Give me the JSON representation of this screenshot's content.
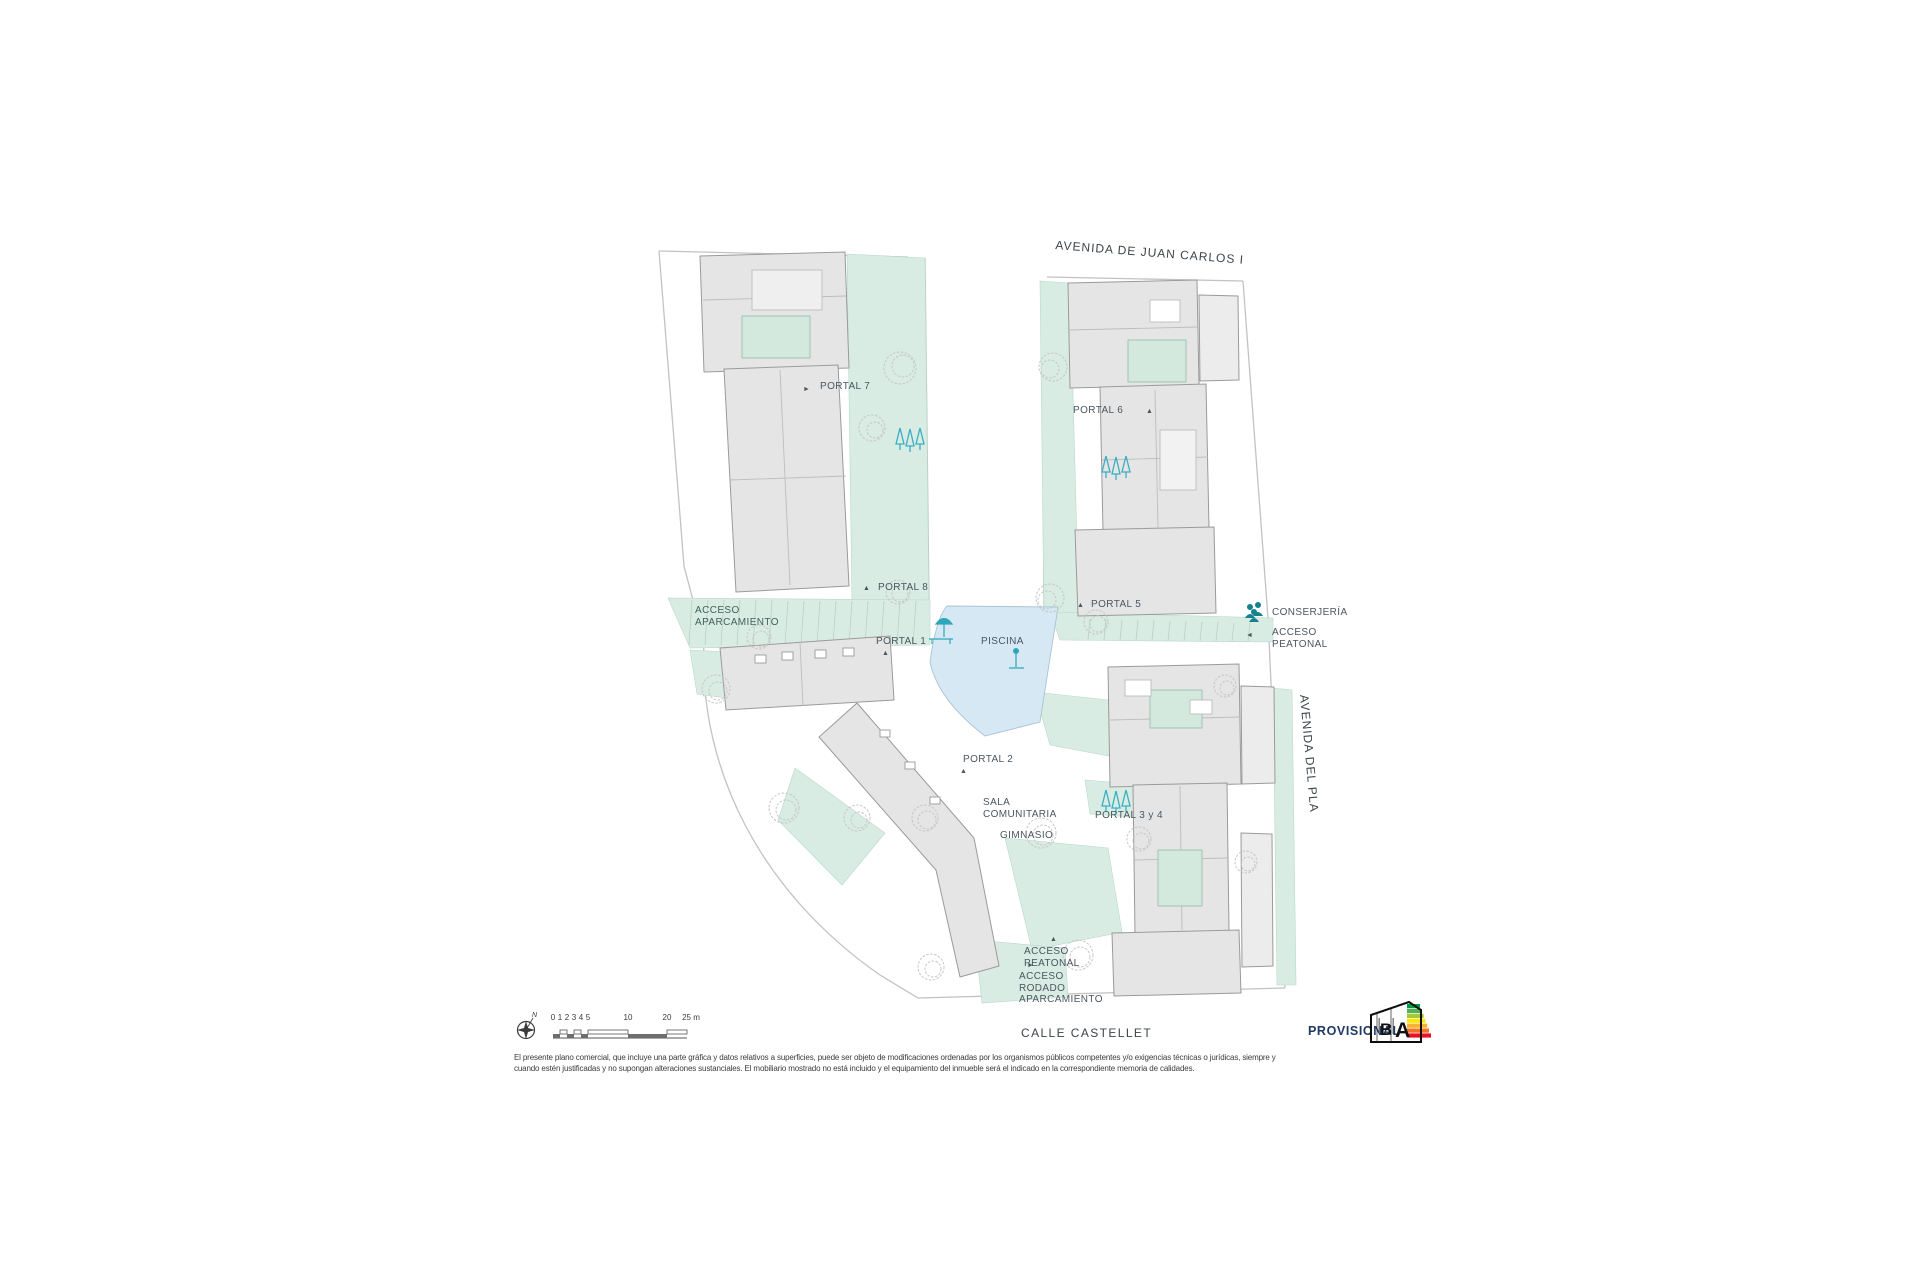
{
  "streets": {
    "top": "AVENIDA DE JUAN CARLOS I",
    "right": "AVENIDA DEL PLA",
    "bottom": "CALLE CASTELLET"
  },
  "labels": {
    "portal7": "PORTAL 7",
    "portal6": "PORTAL 6",
    "portal8": "PORTAL 8",
    "portal5": "PORTAL 5",
    "portal1": "PORTAL 1",
    "portal2": "PORTAL 2",
    "portal34": "PORTAL 3 y 4",
    "piscina": "PISCINA",
    "conserjeria": "CONSERJERÍA",
    "acceso_peatonal": "ACCESO\nPEATONAL",
    "acceso_aparcamiento": "ACCESO\nAPARCAMIENTO",
    "sala_comunitaria": "SALA\nCOMUNITARIA",
    "gimnasio": "GIMNASIO",
    "acceso_peatonal_sur": "ACCESO\nPEATONAL",
    "acceso_rodado": "ACCESO\nRODADO\nAPARCAMIENTO"
  },
  "icons": {
    "triangle_up": "▲",
    "triangle_right": "►",
    "triangle_left": "◄",
    "north": "N"
  },
  "scalebar": {
    "ticks": [
      "0",
      "1",
      "2",
      "3",
      "4",
      "5",
      "10",
      "20",
      "25 m"
    ]
  },
  "stamp": {
    "provisional": "PROVISIONAL"
  },
  "energy": {
    "letters": [
      "B",
      "A"
    ],
    "colors": [
      "#009a44",
      "#52b153",
      "#a6c93c",
      "#ffe800",
      "#fbb034",
      "#f4731f",
      "#e8112d"
    ]
  },
  "disclaimer": {
    "line1": "El presente plano comercial, que incluye una parte gráfica y datos relativos a superficies, puede ser objeto de modificaciones ordenadas por los organismos públicos competentes y/o exigencias técnicas o jurídicas, siempre y",
    "line2": "cuando estén justificadas y no supongan alteraciones sustanciales. El mobiliario mostrado no está incluido y el equipamiento del inmueble será el indicado en la correspondiente memoria de calidades."
  },
  "colors": {
    "green_area": "#d9ece4",
    "pool": "#d6e8f4",
    "building": "#e5e5e5",
    "teal_accent": "#2fa7ba",
    "label_text": "#4b565f",
    "provisional": "#1f3864"
  }
}
